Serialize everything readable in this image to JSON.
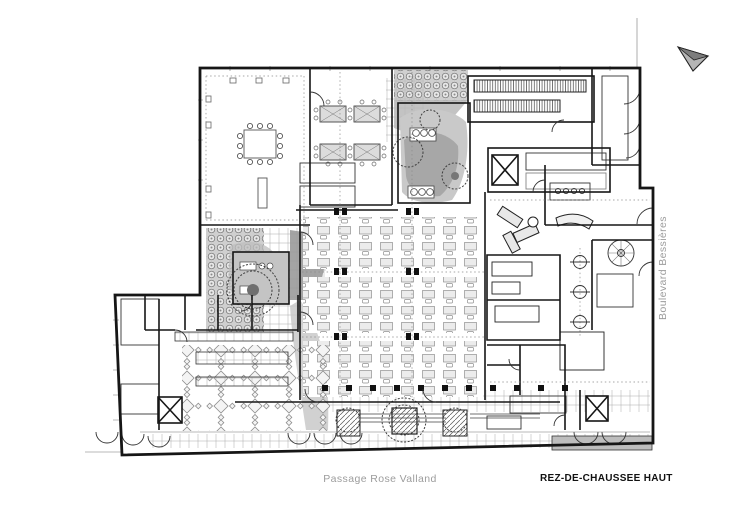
{
  "labels": {
    "street_bottom": {
      "text": "Passage Rose Valland"
    },
    "street_right": {
      "text": "Boulevard Bessières"
    },
    "title": {
      "text": "REZ-DE-CHAUSSEE HAUT"
    }
  },
  "icons": {
    "north_arrow": "north-arrow-icon"
  },
  "colors": {
    "wall": "#161616",
    "line_mid": "#555555",
    "line_light": "#9a9a9a",
    "street_label": "#9c9c9c",
    "title_text": "#111111",
    "paving_dark": "#8f8f8f",
    "paving_mid": "#b5b5b5",
    "paving_light": "#d9d9d9",
    "background": "#ffffff"
  }
}
